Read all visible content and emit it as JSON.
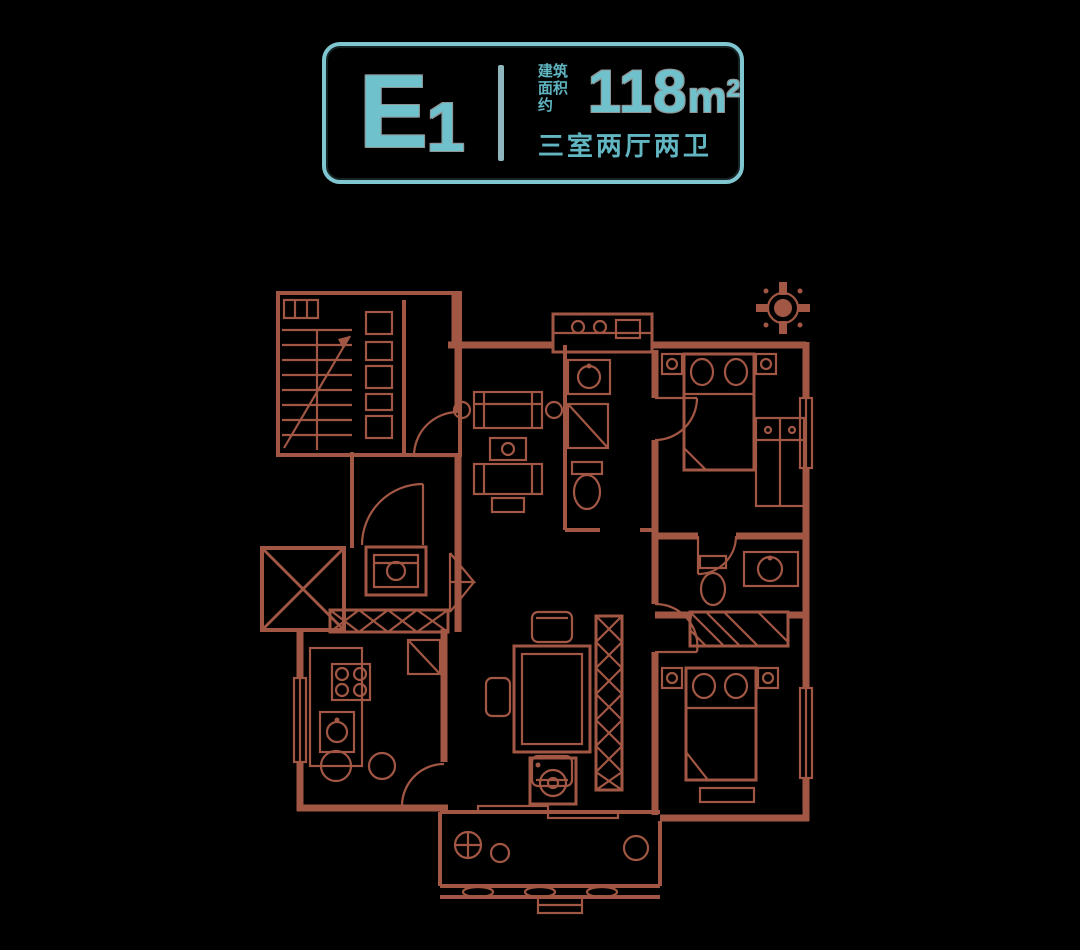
{
  "page": {
    "background": "#000000"
  },
  "badge": {
    "unit_main": "E",
    "unit_sub": "1",
    "area_prefix_top": "建筑",
    "area_prefix_bottom": "面积约",
    "area_value": "118",
    "area_unit_base": "m",
    "area_unit_exp": "2",
    "layout": "三室两厅两卫",
    "accent_color": "#7fc6d1"
  },
  "floorplan": {
    "line_color": "#a25744",
    "features": [
      "staircase",
      "duct-shafts",
      "elevator",
      "entry-door-arc",
      "shoe-cabinet",
      "double-door",
      "living-room-sofa",
      "coffee-table",
      "dining-table",
      "dining-chairs",
      "hatched-wall",
      "kitchen-counter",
      "stove",
      "kitchen-sink",
      "bathroom-toilet",
      "bathroom-sink",
      "shower",
      "bathroom2-toilet",
      "bathroom2-sink",
      "master-bed",
      "second-bed",
      "nightstands",
      "wardrobe",
      "washing-machine",
      "balcony",
      "balcony-railing",
      "plants",
      "bay-window",
      "windows",
      "door-arcs",
      "compass-north"
    ]
  }
}
